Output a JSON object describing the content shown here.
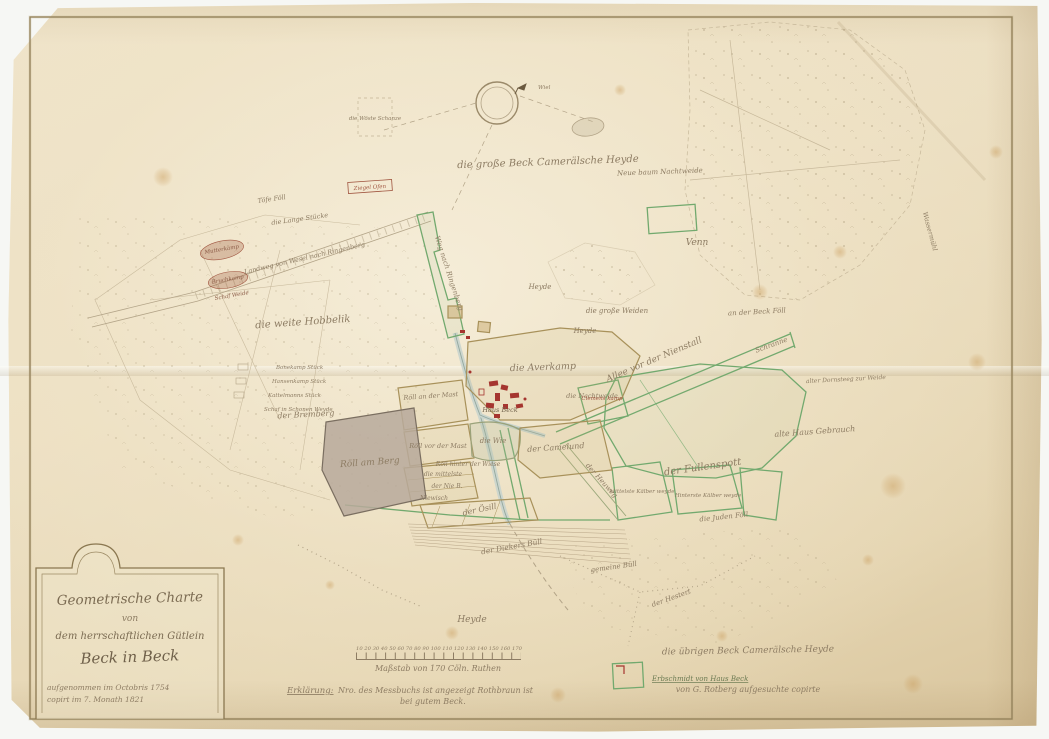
{
  "document": {
    "kind": "hand-drawn cadastral map, aged paper scan"
  },
  "cartouche": {
    "title": "Geometrische Charte",
    "connector": "von",
    "line3": "dem herrschaftlichen Gütlein",
    "estate": "Beck in Beck",
    "note1": "aufgenommen im Octobris 1754",
    "note2": "copirt im 7. Monath 1821"
  },
  "scale": {
    "numbers": "10 20 30 40 50 60 70 80 90 100 110 120 130 140 150 160 170",
    "label": "Maßstab von 170 Cöln. Ruthen"
  },
  "legend": {
    "keyword": "Erklärung:",
    "line1": "Nro. des Messbuchs ist angezeigt Rothbraun ist",
    "line2": "bei gutem Beck."
  },
  "notes": {
    "uebrige": "die übrigen Beck Camerälsche Heyde",
    "erbschmidt": "Erbschmidt von Haus Beck",
    "rotberg": "von G. Rotberg aufgesuchte copirte"
  },
  "map": {
    "labels": {
      "heyde_top": "die große Beck Camerälsche Heyde",
      "venn": "Venn",
      "neue_baum": "Neue baum Nachtweide",
      "wassermuehl": "Wassermühl",
      "beck_foell": "an der Beck Föll",
      "grosse_weiden": "die große Weiden",
      "heyde_a": "Heyde",
      "heyde_b": "Heyde",
      "allee": "Allee vor der Nienstall",
      "schranne": "Schranne",
      "averkamp": "die Averkamp",
      "nachtweide": "die Nachtweide",
      "haus_beck": "Haus Beck",
      "fullenspott": "der Fullenspott",
      "alte_haus": "alte Haus Gebrauch",
      "dornsteeg": "alter Dornsteeg zur Weide",
      "heuweg": "der Heuweg",
      "clemenskamp": "Clemens kamp",
      "kaelber1": "Mittelste Kälber weyde",
      "kaelber2": "Hinterste Kälber weyde",
      "juden_foell": "die Juden Föll",
      "roell_berg": "Röll am Berg",
      "roell_mast1": "Röll an der Mast",
      "roell_mast2": "Röll vor der Mast",
      "die_wie": "die Wie",
      "camelund": "der Camelund",
      "roell_wiese": "Röll hinter der Wiese",
      "mittelste": "die mittelste",
      "nie_b": "der Nie B.",
      "niewisch": "Niewisch",
      "oesill": "der Ösill",
      "hobbelik": "die weite Hobbelik",
      "bremberg": "der Bremberg",
      "heyde_bottom": "Heyde",
      "diekers": "der Diekers Büll",
      "gemeine_buell": "gemeine Büll",
      "hestert": "der Hestert",
      "weg_nw": "Weg nach Ringenberg",
      "landweg": "Landweg von Wesel nach Ringenberg",
      "lange_stuecke": "die Lange Stücke",
      "toefe_foell": "Töfe Föll",
      "ziegel_ofen": "Ziegel Ofen",
      "mutterkamp": "Mutterkamp",
      "bruchkamp": "Bruchkamp",
      "schaf_weide": "Schaf Weide",
      "bonekamp": "Bonekamp Stück",
      "hansenkamp": "Hansenkamp Stück",
      "kattelmann": "Kattelmanns Stück",
      "schonen": "Schaf in Schonen Weyde",
      "woeste": "die Wöste Schanze",
      "wiel": "Wiel"
    }
  },
  "colors": {
    "paper": "#ecdfc2",
    "ink": "#8d7c63",
    "ink_dark": "#74654e",
    "frame": "#8a7750",
    "green_border": "#72a96e",
    "olive_border": "#a8915a",
    "red_building": "#a5352f",
    "gray_parcel": "#b7a99b",
    "pencil": "#c3b496",
    "foxing": "#c89a58"
  }
}
